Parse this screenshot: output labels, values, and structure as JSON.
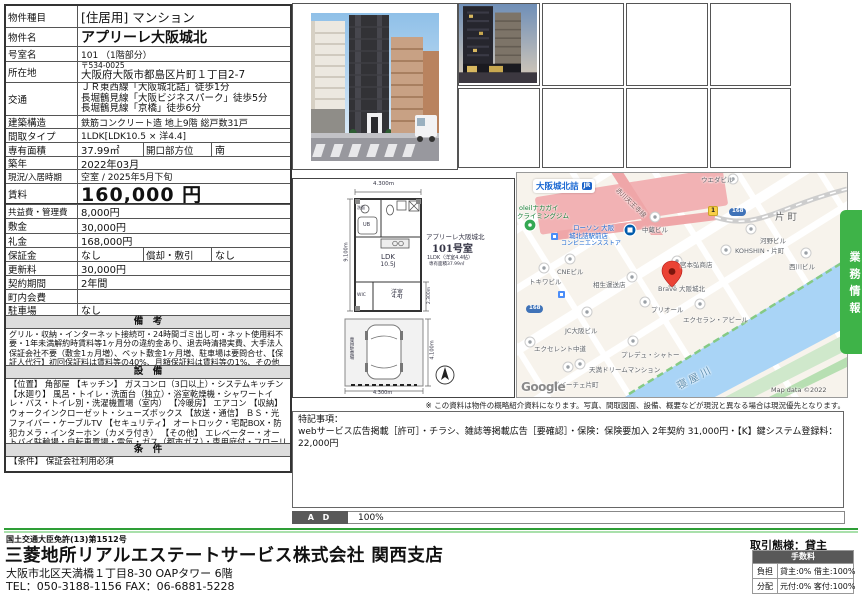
{
  "prop": {
    "rows": [
      {
        "l": "物件種目",
        "v": "[住居用] マンション"
      },
      {
        "l": "物件名",
        "v": "アプリーレ大阪城北"
      },
      {
        "l": "号室名",
        "v": "101 （1階部分）"
      },
      {
        "l": "所在地",
        "v1": "〒534-0025",
        "v2": "大阪府大阪市都島区片町１丁目2-7"
      },
      {
        "l": "交通",
        "v1": "ＪＲ東西線「大阪城北詰」徒歩1分",
        "v2": "長堀鶴見線「大阪ビジネスパーク」徒歩5分",
        "v3": "長堀鶴見線「京橋」徒歩6分"
      },
      {
        "l": "建築構造",
        "v": "鉄筋コンクリート造 地上9階 総戸数31戸"
      },
      {
        "l": "間取タイプ",
        "v": "1LDK[LDK10.5 × 洋4.4]"
      },
      {
        "l": "専有面積",
        "v": "37.99㎡",
        "l2": "開口部方位",
        "v2": "南"
      },
      {
        "l": "築年",
        "v": "2022年03月"
      },
      {
        "l": "現況/入居時期",
        "v": "空室 / 2025年5月下旬"
      },
      {
        "l": "賃料",
        "v": "160,000 円"
      },
      {
        "l": "共益費・管理費",
        "v": "8,000円"
      },
      {
        "l": "敷金",
        "v": "30,000円"
      },
      {
        "l": "礼金",
        "v": "168,000円"
      },
      {
        "l": "保証金",
        "v": "なし",
        "l2": "償却・敷引",
        "v2": "なし"
      },
      {
        "l": "更新料",
        "v": "30,000円"
      },
      {
        "l": "契約期間",
        "v": "2年間"
      },
      {
        "l": "町内会費",
        "v": ""
      },
      {
        "l": "駐車場",
        "v": "なし"
      }
    ],
    "biko_h": "備　考",
    "biko_t": "グリル・収納・インターネット接続可・24時間ゴミ出し可・ネット使用料不要・1年未満解約時賃料等1ヶ月分の違約金あり、退去時清掃実費、大手法人保証会社不要（敷金1ヵ月増）、ペット敷金1ヶ月増、駐車場は要問合せ、【保証人代行】初回保証料は賃料等の40%、月額保証料は賃料等の1%、その他保証会社条件有",
    "setsubi_h": "設　備",
    "setsubi_t": "【位置】 角部屋 【キッチン】 ガスコンロ（3口以上）・システムキッチン 【水廻り】 風呂・トイレ・洗面台（独立）・浴室乾燥機・シャワートイレ・バス・トイレ別・洗濯機置場（室内） 【冷暖房】 エアコン 【収納】 ウォークインクローゼット・シューズボックス 【放送・通信】 ＢＳ・光ファイバー・ケーブルTV 【セキュリティ】 オートロック・宅配BOX・防犯カメラ・インターホン（カメラ付き） 【その他】 エレベーター・オートバイ駐輪場・自転車置場・電気・ガス（都市ガス）・専用庭付・フローリング",
    "joken_h": "条　件",
    "joken_t": "【条件】 保証会社利用必須"
  },
  "floorplan": {
    "dim_top": "4.300m",
    "dim_left": "9.100m",
    "dim_r1": "2.300m",
    "dim_r2": "4.100m",
    "dim_bottom": "4.300m",
    "t1": "アプリーレ大阪城北",
    "t2": "101号室",
    "t3": "1LDK（洋室4.4帖）",
    "t4": "専有面積37.99㎡",
    "ldk1": "LDK",
    "ldk2": "10.5J",
    "yo1": "洋室",
    "yo2": "4.4J",
    "wic": "WIC",
    "ub": "UB",
    "senmen": "洗面",
    "parking": "専用駐車場"
  },
  "map": {
    "station": "大阪城北詰",
    "jr": "JR",
    "climb1": "oleilナカガイ",
    "climb2": "クライミングジム",
    "lawson1": "ローソン 大阪",
    "lawson2": "城北詰駅前店",
    "lawson3": "コンビニエンスストア",
    "road": "赤川天王寺線",
    "river": "寝屋川",
    "katamachi": "片町",
    "shield1": "1",
    "shield168": "168",
    "google": "Google",
    "attribution": "Map data ©2022",
    "pois": [
      {
        "t": "ウエダビル"
      },
      {
        "t": "中蔵ビル"
      },
      {
        "t": "河野ビル"
      },
      {
        "t": "KOHSHIN・片町"
      },
      {
        "t": "西川ビル"
      },
      {
        "t": "CNEビル"
      },
      {
        "t": "トキワビル"
      },
      {
        "t": "相生運送店"
      },
      {
        "t": "宮本弘商店"
      },
      {
        "t": "Brave 大阪城北"
      },
      {
        "t": "プリオール"
      },
      {
        "t": "エクセラン・アビール"
      },
      {
        "t": "JC大阪ビル"
      },
      {
        "t": "エクセレント中道"
      },
      {
        "t": "プレデュ・シャトー"
      },
      {
        "t": "天満ドリームマンション"
      },
      {
        "t": "ビバーチェ片町"
      }
    ]
  },
  "banner": {
    "label": "業務情報"
  },
  "notes": {
    "disclaimer": "※ この資料は物件の概略紹介資料になります。写真、間取図面、設備、概要などが現況と異なる場合は現況優先となります。",
    "special_title": "特記事項：",
    "special_body": "webサービス広告掲載［許可］・チラシ、雑誌等掲載広告［要確認］・保険：保険要加入 2年契約 31,000円・【K】鍵システム登録料：22,000円",
    "ad_label": "A D",
    "ad_value": "100%"
  },
  "footer": {
    "license": "国土交通大臣免許(13)第1512号",
    "company": "三菱地所リアルエステートサービス株式会社 関西支店",
    "address": "大阪市北区天満橋１丁目8-30 OAPタワー 6階",
    "tel": "TEL：050-3188-1156 FAX：06-6881-5228",
    "deal": "取引態様：貸主",
    "fee_header": "手数料",
    "fee_r1l": "負担",
    "fee_r1v": "貸主:0% 借主:100%",
    "fee_r2l": "分配",
    "fee_r2v": "元付:0% 客付:100%"
  },
  "colors": {
    "accent_green": "#3eb348",
    "pin_red": "#ea4335",
    "water_blue": "#a9d4f6",
    "road_pink": "#efa6a8"
  }
}
